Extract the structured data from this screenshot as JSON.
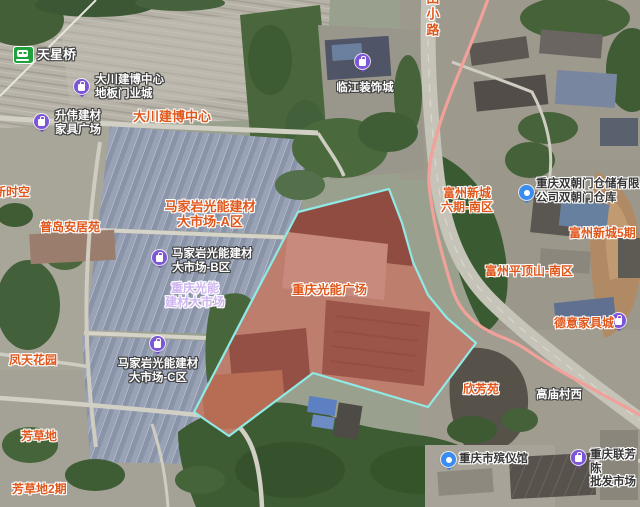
{
  "labels": {
    "tianxingqiao": "天星桥",
    "dachuan_poi": "大川建博中心\n地板门业城",
    "shengwei": "升伟建材\n家具广场",
    "dachuan_area": "大川建博中心",
    "linjiang": "临江装饰城",
    "road_vertical": "田小路",
    "xinshikong": "新时空",
    "pudao": "普岛安居苑",
    "fengtian": "凤天花园",
    "majiayan_a": "马家岩光能建材\n大市场-A区",
    "majiayan_b": "马家岩光能建材\n大市场-B区",
    "majiayan_c": "马家岩光能建材\n大市场-C区",
    "guangneng_aoi": "重庆光能\n建材大市场",
    "guangneng_plaza": "重庆光能广场",
    "fuzhou6": "富州新城\n六期-南区",
    "shuangchaomen": "重庆双朝门仓储有限\n公司双朝门仓库",
    "fuzhou5": "富州新城5期",
    "pingdingshan": "富州平顶山-南区",
    "deyi": "德意家具城",
    "xinfangyuan": "欣芳苑",
    "gaomiao": "高庙村西",
    "fangcaodi": "芳草地",
    "fangcaodi2": "芳草地2期",
    "binyiguan": "重庆市殡仪馆",
    "lianfang": "重庆联芳陈\n批发市场"
  },
  "overlay": {
    "highlight_area_name": "重庆光能广场",
    "fill_color": "#c94436",
    "border_color": "#8fe9e5"
  },
  "colors": {
    "route_line": "#f0a19a",
    "poi_pin_purple": "#7d55d9",
    "poi_pin_blue": "#3b8cf0",
    "metro_icon_green": "#1fa23c",
    "label_orange": "#e0571b",
    "label_white": "#ffffff",
    "label_dark": "#353535",
    "label_lavender": "#cfb6f0"
  }
}
